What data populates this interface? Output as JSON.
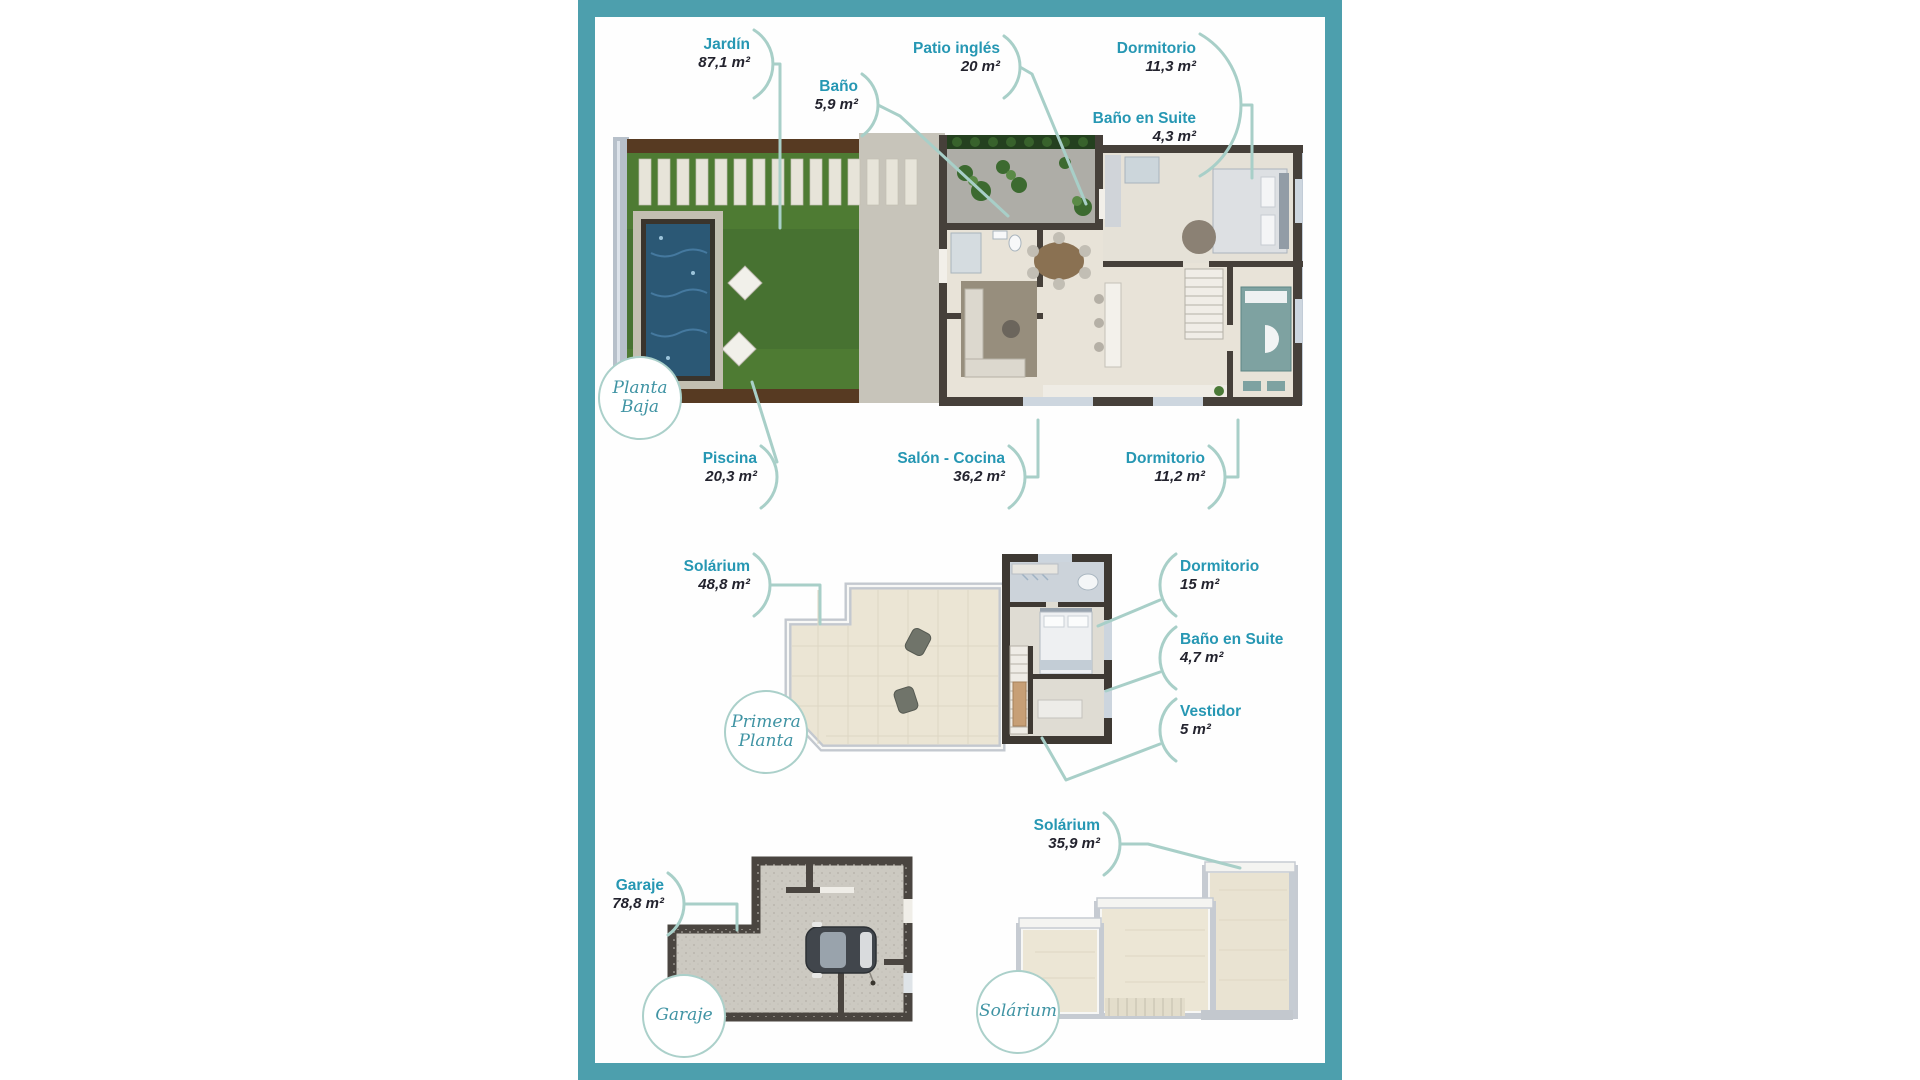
{
  "colors": {
    "frame_teal": "#4d9fad",
    "label_teal": "#2697b3",
    "area_text": "#23232e",
    "connector": "#a8cfc8",
    "badge_text": "#4094a4"
  },
  "planta_baja": {
    "badge": {
      "line1": "Planta",
      "line2": "Baja"
    },
    "labels": {
      "jardin": {
        "name": "Jardín",
        "area": "87,1 m²"
      },
      "bano": {
        "name": "Baño",
        "area": "5,9 m²"
      },
      "patio_ingles": {
        "name": "Patio inglés",
        "area": "20 m²"
      },
      "dormitorio": {
        "name": "Dormitorio",
        "area": "11,3 m²"
      },
      "bano_en_suite": {
        "name": "Baño en Suite",
        "area": "4,3 m²"
      },
      "piscina": {
        "name": "Piscina",
        "area": "20,3 m²"
      },
      "salon_cocina": {
        "name": "Salón - Cocina",
        "area": "36,2 m²"
      },
      "dormitorio_2": {
        "name": "Dormitorio",
        "area": "11,2 m²"
      }
    }
  },
  "primera_planta": {
    "badge": {
      "line1": "Primera",
      "line2": "Planta"
    },
    "labels": {
      "solarium": {
        "name": "Solárium",
        "area": "48,8 m²"
      },
      "dormitorio": {
        "name": "Dormitorio",
        "area": "15 m²"
      },
      "bano_en_suite": {
        "name": "Baño en Suite",
        "area": "4,7 m²"
      },
      "vestidor": {
        "name": "Vestidor",
        "area": "5 m²"
      }
    }
  },
  "garaje": {
    "badge": {
      "line1": "Garaje"
    },
    "labels": {
      "garaje": {
        "name": "Garaje",
        "area": "78,8 m²"
      }
    }
  },
  "solarium": {
    "badge": {
      "line1": "Solárium"
    },
    "labels": {
      "solarium": {
        "name": "Solárium",
        "area": "35,9 m²"
      }
    }
  }
}
